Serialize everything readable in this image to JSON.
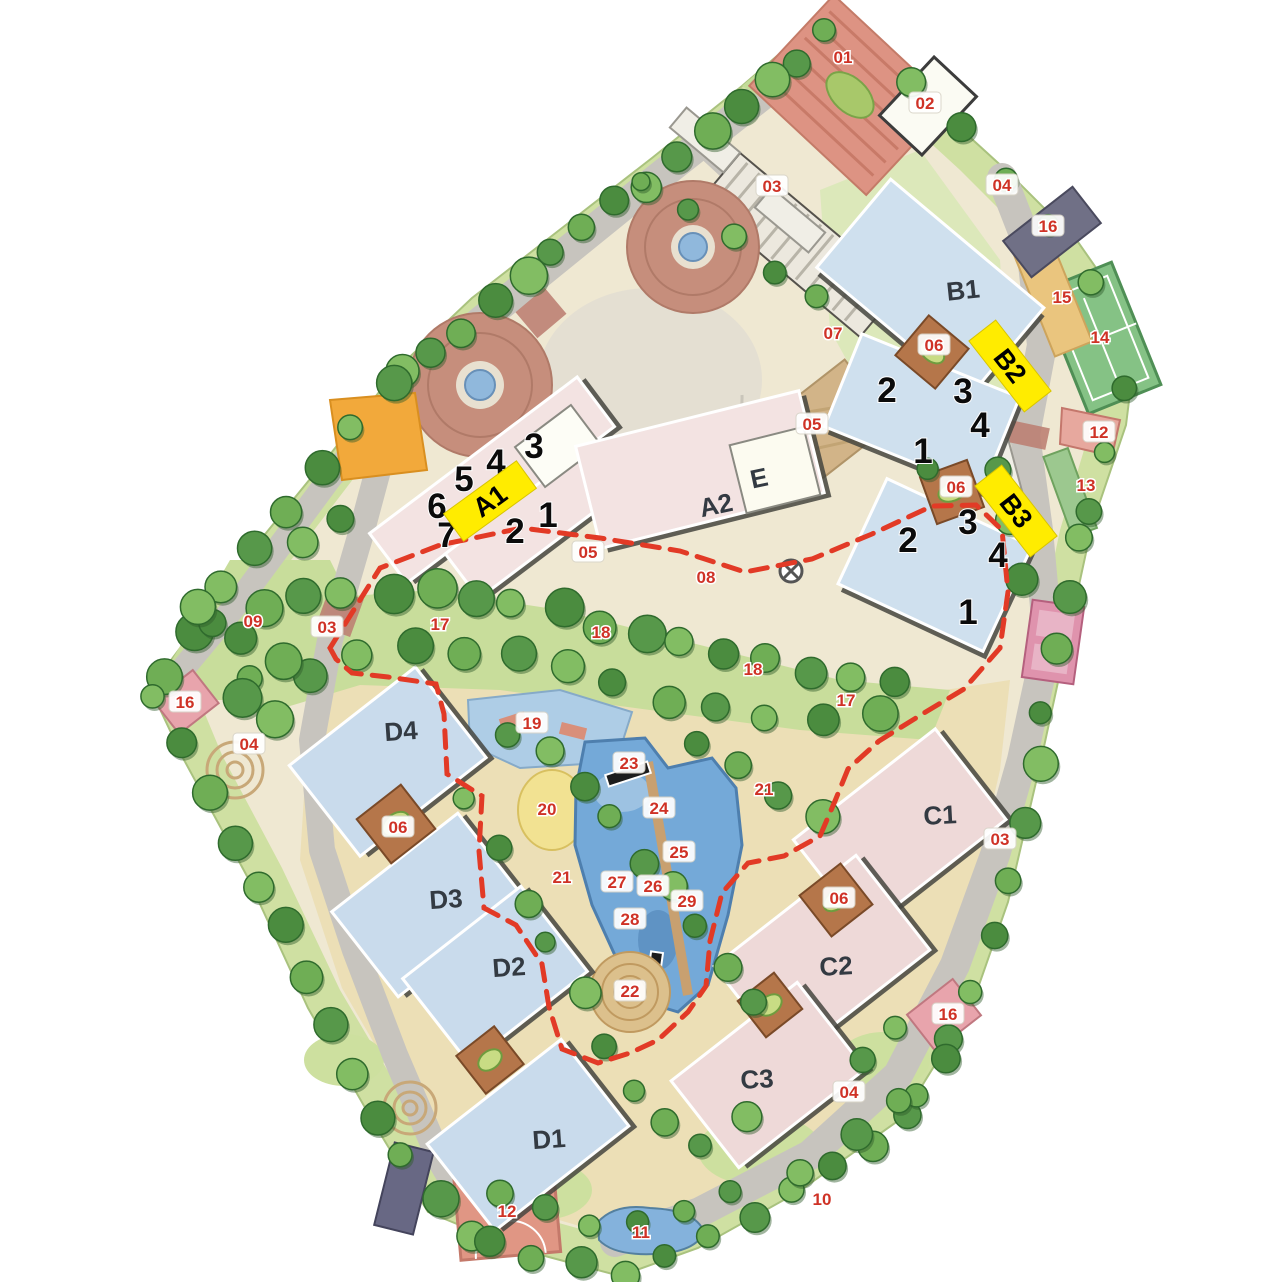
{
  "map": {
    "type": "residential-site-plan",
    "colors": {
      "highlight_yellow": "#ffec00",
      "marker_red": "#cf3226",
      "boundary_dash_red": "#e23a26",
      "building_blue": "#cfe0ee",
      "building_pink": "#f3e3e2",
      "road_gray": "#c7c4be",
      "tree_green": "#6fae55",
      "pool_blue": "#74a9d8",
      "lawn_green": "#c8dd9b"
    },
    "building_labels": [
      {
        "id": "B1",
        "label": "B1",
        "x": 963,
        "y": 290,
        "rot": -6
      },
      {
        "id": "A2",
        "label": "A2",
        "x": 716,
        "y": 505,
        "rot": -12
      },
      {
        "id": "E",
        "label": "E",
        "x": 759,
        "y": 478,
        "rot": -12
      },
      {
        "id": "C1",
        "label": "C1",
        "x": 940,
        "y": 815,
        "rot": -3
      },
      {
        "id": "C2",
        "label": "C2",
        "x": 836,
        "y": 966,
        "rot": -3
      },
      {
        "id": "C3",
        "label": "C3",
        "x": 757,
        "y": 1079,
        "rot": -3
      },
      {
        "id": "D4",
        "label": "D4",
        "x": 401,
        "y": 731,
        "rot": -4
      },
      {
        "id": "D3",
        "label": "D3",
        "x": 446,
        "y": 899,
        "rot": -4
      },
      {
        "id": "D2",
        "label": "D2",
        "x": 509,
        "y": 967,
        "rot": -4
      },
      {
        "id": "D1",
        "label": "D1",
        "x": 549,
        "y": 1139,
        "rot": -4
      }
    ],
    "highlight_tags": [
      {
        "label": "A1",
        "x": 490,
        "y": 501,
        "rot": -36
      },
      {
        "label": "B2",
        "x": 1010,
        "y": 366,
        "rot": 52
      },
      {
        "label": "B3",
        "x": 1016,
        "y": 511,
        "rot": 52
      }
    ],
    "unit_numbers": [
      {
        "building": "A1",
        "label": "3",
        "x": 534,
        "y": 446
      },
      {
        "building": "A1",
        "label": "4",
        "x": 496,
        "y": 462
      },
      {
        "building": "A1",
        "label": "5",
        "x": 464,
        "y": 479
      },
      {
        "building": "A1",
        "label": "6",
        "x": 437,
        "y": 506
      },
      {
        "building": "A1",
        "label": "7",
        "x": 447,
        "y": 535
      },
      {
        "building": "A1",
        "label": "1",
        "x": 548,
        "y": 515
      },
      {
        "building": "A1",
        "label": "2",
        "x": 515,
        "y": 531
      },
      {
        "building": "B2",
        "label": "2",
        "x": 887,
        "y": 390
      },
      {
        "building": "B2",
        "label": "3",
        "x": 963,
        "y": 391
      },
      {
        "building": "B2",
        "label": "4",
        "x": 980,
        "y": 425
      },
      {
        "building": "B2",
        "label": "1",
        "x": 923,
        "y": 451
      },
      {
        "building": "B3",
        "label": "2",
        "x": 908,
        "y": 540
      },
      {
        "building": "B3",
        "label": "3",
        "x": 968,
        "y": 522
      },
      {
        "building": "B3",
        "label": "4",
        "x": 998,
        "y": 555
      },
      {
        "building": "B3",
        "label": "1",
        "x": 968,
        "y": 612
      }
    ],
    "amenity_markers": [
      {
        "label": "01",
        "x": 843,
        "y": 57,
        "pill": false
      },
      {
        "label": "02",
        "x": 925,
        "y": 103,
        "pill": true
      },
      {
        "label": "03",
        "x": 772,
        "y": 186,
        "pill": true
      },
      {
        "label": "04",
        "x": 1002,
        "y": 185,
        "pill": true
      },
      {
        "label": "16",
        "x": 1048,
        "y": 226,
        "pill": true
      },
      {
        "label": "15",
        "x": 1062,
        "y": 297,
        "pill": false
      },
      {
        "label": "14",
        "x": 1100,
        "y": 337,
        "pill": false
      },
      {
        "label": "07",
        "x": 833,
        "y": 333,
        "pill": false
      },
      {
        "label": "06",
        "x": 934,
        "y": 345,
        "pill": true
      },
      {
        "label": "05",
        "x": 812,
        "y": 424,
        "pill": true
      },
      {
        "label": "12",
        "x": 1099,
        "y": 432,
        "pill": true
      },
      {
        "label": "13",
        "x": 1086,
        "y": 485,
        "pill": false
      },
      {
        "label": "06",
        "x": 956,
        "y": 487,
        "pill": true
      },
      {
        "label": "05",
        "x": 588,
        "y": 552,
        "pill": true
      },
      {
        "label": "08",
        "x": 706,
        "y": 577,
        "pill": false
      },
      {
        "label": "09",
        "x": 253,
        "y": 621,
        "pill": false
      },
      {
        "label": "03",
        "x": 327,
        "y": 627,
        "pill": true
      },
      {
        "label": "17",
        "x": 440,
        "y": 624,
        "pill": false
      },
      {
        "label": "18",
        "x": 601,
        "y": 632,
        "pill": false
      },
      {
        "label": "18",
        "x": 753,
        "y": 669,
        "pill": false
      },
      {
        "label": "17",
        "x": 846,
        "y": 700,
        "pill": false
      },
      {
        "label": "16",
        "x": 185,
        "y": 702,
        "pill": true
      },
      {
        "label": "19",
        "x": 532,
        "y": 723,
        "pill": true
      },
      {
        "label": "04",
        "x": 249,
        "y": 744,
        "pill": true
      },
      {
        "label": "23",
        "x": 629,
        "y": 763,
        "pill": true
      },
      {
        "label": "21",
        "x": 764,
        "y": 789,
        "pill": false
      },
      {
        "label": "24",
        "x": 659,
        "y": 808,
        "pill": true
      },
      {
        "label": "20",
        "x": 547,
        "y": 809,
        "pill": false
      },
      {
        "label": "06",
        "x": 398,
        "y": 827,
        "pill": true
      },
      {
        "label": "03",
        "x": 1000,
        "y": 839,
        "pill": true
      },
      {
        "label": "25",
        "x": 679,
        "y": 852,
        "pill": true
      },
      {
        "label": "21",
        "x": 562,
        "y": 877,
        "pill": false
      },
      {
        "label": "27",
        "x": 617,
        "y": 882,
        "pill": true
      },
      {
        "label": "26",
        "x": 653,
        "y": 886,
        "pill": true
      },
      {
        "label": "06",
        "x": 839,
        "y": 898,
        "pill": true
      },
      {
        "label": "29",
        "x": 687,
        "y": 901,
        "pill": true
      },
      {
        "label": "28",
        "x": 630,
        "y": 919,
        "pill": true
      },
      {
        "label": "22",
        "x": 630,
        "y": 991,
        "pill": true
      },
      {
        "label": "16",
        "x": 948,
        "y": 1014,
        "pill": true
      },
      {
        "label": "04",
        "x": 849,
        "y": 1092,
        "pill": true
      },
      {
        "label": "12",
        "x": 507,
        "y": 1211,
        "pill": false
      },
      {
        "label": "11",
        "x": 641,
        "y": 1232,
        "pill": false
      },
      {
        "label": "10",
        "x": 822,
        "y": 1199,
        "pill": false
      }
    ]
  }
}
